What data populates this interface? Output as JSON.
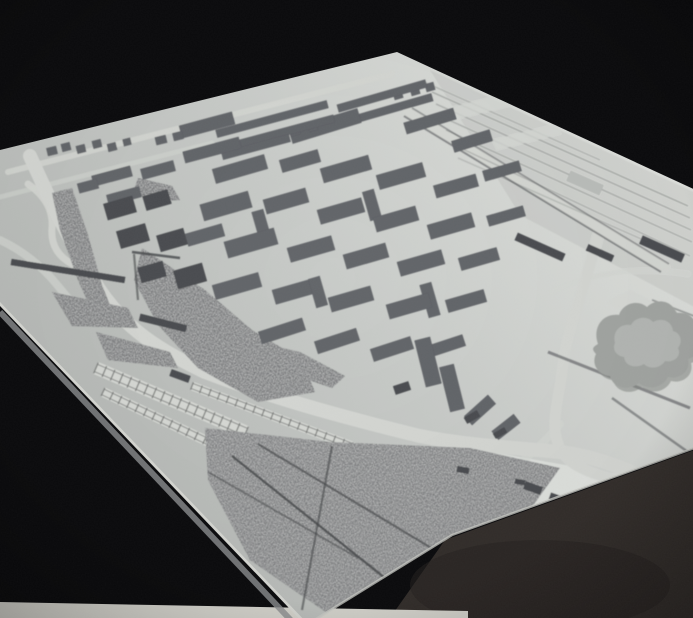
{
  "meta": {
    "subject": "architectural-scale-model-photo",
    "width": 693,
    "height": 618
  },
  "palette": {
    "background": "#0b0b0d",
    "base_hi": "#e4e6e2",
    "base_mid": "#c9ccc9",
    "base_lo": "#b4b7b4",
    "edge_band": "#d8d9d4",
    "edge_band_shadow": "#8e9092",
    "edge_highlight": "#c9cbc6",
    "bottom_strip": "#d5d4cd",
    "table": "#332e2b",
    "table_shadow": "#262220",
    "building_top": "#64666b",
    "building_side": "#37393d",
    "building_top_light": "#bcbfbc",
    "building_side_light": "#8f918f",
    "building_top_dark": "#4b4d51",
    "building_side_dark": "#2c2e32",
    "park": "#6e7072",
    "hill": "#747678",
    "road_light": "#d6d8d4",
    "ladder_band": "#d9dbd7",
    "ladder_rail": "#8e908e",
    "ladder_tie": "#7c7e7c",
    "rail": "#a8aba8",
    "dark": "#55575a",
    "crease": "#46484a",
    "blob_fill": "#a3a6a3",
    "blob_inner": "#b5b8b5",
    "blob_shadow": "#858885",
    "patch_light": "#d7d9d5"
  },
  "model_outline": [
    [
      0,
      150
    ],
    [
      397,
      52
    ],
    [
      700,
      192
    ],
    [
      700,
      446
    ],
    [
      452,
      535
    ],
    [
      308,
      624
    ],
    [
      0,
      302
    ]
  ],
  "bottom_strip": [
    [
      0,
      602
    ],
    [
      468,
      611
    ],
    [
      468,
      618
    ],
    [
      0,
      618
    ]
  ],
  "table_polygon": [
    [
      445,
      540
    ],
    [
      700,
      448
    ],
    [
      700,
      618
    ],
    [
      390,
      618
    ]
  ],
  "table_shadow_ellipse": {
    "cx": 540,
    "cy": 585,
    "rx": 130,
    "ry": 45,
    "opacity": 0.55
  },
  "edge_band": {
    "line": [
      0,
      298,
      310,
      622
    ],
    "shadow": [
      0,
      312,
      302,
      632
    ]
  },
  "edge_highlight_path": "M 700 446 L 452 535 L 308 624",
  "shading": {
    "bright_patch": [
      [
        468,
        448
      ],
      [
        640,
        478
      ],
      [
        610,
        540
      ],
      [
        500,
        548
      ]
    ],
    "tilt_shade": [
      [
        430,
        70
      ],
      [
        700,
        195
      ],
      [
        700,
        310
      ],
      [
        520,
        215
      ]
    ]
  },
  "roads": [
    {
      "d": "M 8 172 L 392 74",
      "w": 6,
      "o": 0.85
    },
    {
      "d": "M 0 197 L 212 143",
      "w": 5,
      "o": 0.55
    },
    {
      "d": "M 30 156 C 48 196 62 226 92 278 C 118 322 150 346 205 372 C 268 396 330 414 420 436 C 470 446 520 448 560 452 C 598 456 636 472 672 492",
      "w": 14,
      "o": 1
    },
    {
      "d": "M 28 184 Q 54 202 52 228 Q 50 252 72 264",
      "w": 7,
      "o": 0.9
    },
    {
      "d": "M 0 240 Q 34 256 58 286 Q 74 306 92 322",
      "w": 8,
      "o": 0.65
    },
    {
      "d": "M 598 236 C 584 290 566 330 562 372 C 558 404 548 428 562 452 C 574 472 612 478 648 490",
      "w": 11,
      "o": 1
    },
    {
      "d": "M 408 112 L 665 268",
      "w": 10,
      "o": 0.85
    },
    {
      "d": "M 552 292 Q 612 262 688 274",
      "w": 5,
      "o": 0.75
    },
    {
      "d": "M 560 424 C 536 452 516 468 486 486",
      "w": 8,
      "o": 0.65
    }
  ],
  "lines_under": [
    [
      432,
      92,
      688,
      206,
      1.5,
      "rail",
      0.9
    ],
    [
      436,
      104,
      690,
      218,
      1.5,
      "rail",
      0.85
    ],
    [
      440,
      116,
      691,
      230,
      1.5,
      "rail",
      0.8
    ],
    [
      446,
      130,
      692,
      242,
      1.5,
      "rail",
      0.8
    ],
    [
      452,
      144,
      690,
      256,
      1.5,
      "rail",
      0.7
    ],
    [
      424,
      82,
      600,
      160,
      1.5,
      "rail",
      0.7
    ],
    [
      458,
      158,
      648,
      242,
      1.5,
      "rail",
      0.6
    ],
    [
      404,
      116,
      661,
      272,
      2,
      "dark",
      0.6
    ],
    [
      412,
      108,
      669,
      264,
      1.8,
      "dark",
      0.5
    ],
    [
      548,
      352,
      690,
      408,
      3,
      "dark",
      0.6
    ],
    [
      612,
      398,
      688,
      452,
      2.5,
      "dark",
      0.55
    ],
    [
      652,
      300,
      694,
      316,
      2,
      "dark",
      0.45
    ],
    [
      172,
      292,
      310,
      384,
      2,
      "dark",
      0.45
    ]
  ],
  "lines_over": [
    [
      232,
      456,
      420,
      606,
      2.5,
      "crease",
      0.8
    ],
    [
      258,
      444,
      498,
      588,
      2.2,
      "crease",
      0.65
    ],
    [
      332,
      446,
      302,
      610,
      2.2,
      "crease",
      0.6
    ],
    [
      208,
      472,
      358,
      558,
      2,
      "crease",
      0.5
    ],
    [
      132,
      252,
      180,
      258,
      2.5,
      "crease",
      0.8
    ],
    [
      134,
      254,
      138,
      300,
      2.2,
      "crease",
      0.6
    ]
  ],
  "ladders": [
    [
      96,
      368,
      246,
      432,
      13
    ],
    [
      103,
      392,
      230,
      452,
      10
    ],
    [
      192,
      386,
      352,
      446,
      9
    ],
    [
      352,
      446,
      430,
      470,
      8
    ]
  ],
  "parks": [
    {
      "fill": "park",
      "points": [
        [
          52,
          193
        ],
        [
          72,
          188
        ],
        [
          88,
          235
        ],
        [
          102,
          285
        ],
        [
          112,
          310
        ],
        [
          95,
          318
        ],
        [
          78,
          280
        ],
        [
          60,
          230
        ]
      ]
    },
    {
      "fill": "park",
      "points": [
        [
          142,
          248
        ],
        [
          205,
          290
        ],
        [
          252,
          330
        ],
        [
          302,
          360
        ],
        [
          315,
          392
        ],
        [
          258,
          402
        ],
        [
          198,
          368
        ],
        [
          158,
          325
        ],
        [
          134,
          280
        ]
      ]
    },
    {
      "fill": "hill",
      "points": [
        [
          205,
          428
        ],
        [
          330,
          442
        ],
        [
          470,
          448
        ],
        [
          560,
          468
        ],
        [
          505,
          545
        ],
        [
          420,
          600
        ],
        [
          330,
          615
        ],
        [
          250,
          560
        ],
        [
          208,
          480
        ]
      ]
    },
    {
      "fill": "park",
      "points": [
        [
          212,
          332
        ],
        [
          300,
          352
        ],
        [
          345,
          376
        ],
        [
          332,
          388
        ],
        [
          250,
          360
        ],
        [
          208,
          348
        ]
      ]
    },
    {
      "fill": "park",
      "points": [
        [
          138,
          178
        ],
        [
          172,
          186
        ],
        [
          180,
          200
        ],
        [
          150,
          202
        ],
        [
          134,
          190
        ]
      ]
    },
    {
      "fill": "park",
      "points": [
        [
          52,
          292
        ],
        [
          128,
          308
        ],
        [
          138,
          328
        ],
        [
          72,
          326
        ]
      ]
    },
    {
      "fill": "park",
      "points": [
        [
          96,
          332
        ],
        [
          170,
          352
        ],
        [
          178,
          368
        ],
        [
          108,
          360
        ]
      ]
    }
  ],
  "patches": [
    [
      [
        607,
        302
      ],
      [
        630,
        290
      ],
      [
        655,
        303
      ],
      [
        631,
        316
      ]
    ],
    [
      [
        452,
        107
      ],
      [
        508,
        93
      ],
      [
        514,
        105
      ],
      [
        458,
        119
      ]
    ],
    [
      [
        492,
        140
      ],
      [
        556,
        124
      ],
      [
        561,
        134
      ],
      [
        497,
        150
      ]
    ]
  ],
  "blob": {
    "outer": "M 598 344 C 592 327 603 313 619 315 C 623 303 638 299 647 307 C 657 297 673 301 676 313 C 690 311 700 322 695 333 C 704 342 700 356 688 359 C 691 371 680 380 668 377 C 663 388 648 391 639 383 C 628 392 613 388 610 376 C 598 375 591 364 596 354 C 591 349 593 347 598 344 Z",
    "inner": "M 615 343 C 612 332 620 323 631 325 C 635 317 647 315 653 322 C 662 317 672 321 673 331 C 681 333 683 342 678 348 C 682 356 674 363 665 361 C 661 368 650 370 644 364 C 635 369 625 366 624 357 C 616 356 612 349 615 343 Z",
    "shadow_dx": 3,
    "shadow_dy": 4
  },
  "buildings": [
    [
      52,
      151,
      10,
      8,
      -14,
      4,
      0
    ],
    [
      66,
      147,
      9,
      8,
      -14,
      4,
      0
    ],
    [
      81,
      149,
      9,
      8,
      -14,
      4,
      0
    ],
    [
      97,
      144,
      9,
      8,
      -14,
      4,
      0
    ],
    [
      112,
      147,
      9,
      8,
      -14,
      4,
      0
    ],
    [
      127,
      142,
      8,
      7,
      -14,
      4,
      0
    ],
    [
      161,
      140,
      11,
      8,
      -14,
      4,
      0
    ],
    [
      178,
      136,
      10,
      8,
      -14,
      4,
      0
    ],
    [
      295,
      131,
      10,
      9,
      -16,
      4,
      0
    ],
    [
      313,
      127,
      9,
      8,
      -16,
      4,
      0
    ],
    [
      331,
      122,
      9,
      8,
      -16,
      4,
      0
    ],
    [
      350,
      117,
      9,
      8,
      -16,
      4,
      0
    ],
    [
      398,
      95,
      9,
      8,
      -16,
      4,
      0
    ],
    [
      415,
      91,
      9,
      8,
      -16,
      4,
      0
    ],
    [
      430,
      87,
      9,
      8,
      -16,
      4,
      0
    ],
    [
      272,
      119,
      115,
      8,
      -15,
      9,
      0
    ],
    [
      280,
      133,
      112,
      8,
      -15,
      9,
      0
    ],
    [
      256,
      147,
      70,
      8,
      -15,
      8,
      0
    ],
    [
      382,
      96,
      92,
      8,
      -16,
      9,
      0
    ],
    [
      391,
      109,
      86,
      8,
      -16,
      9,
      0
    ],
    [
      112,
      176,
      40,
      11,
      -15,
      8,
      0
    ],
    [
      158,
      170,
      34,
      11,
      -15,
      8,
      0
    ],
    [
      124,
      196,
      34,
      11,
      -15,
      8,
      0
    ],
    [
      88,
      186,
      20,
      10,
      -15,
      6,
      0
    ],
    [
      120,
      208,
      30,
      17,
      -16,
      14,
      2
    ],
    [
      157,
      200,
      26,
      15,
      -16,
      12,
      2
    ],
    [
      133,
      236,
      30,
      18,
      -16,
      18,
      2
    ],
    [
      172,
      240,
      28,
      17,
      -16,
      20,
      2
    ],
    [
      152,
      272,
      26,
      16,
      -16,
      22,
      2
    ],
    [
      190,
      276,
      30,
      19,
      -16,
      24,
      2
    ],
    [
      205,
      235,
      38,
      13,
      -16,
      8,
      0
    ],
    [
      207,
      125,
      55,
      13,
      -15,
      10,
      0
    ],
    [
      212,
      150,
      58,
      12,
      -15,
      10,
      0
    ],
    [
      325,
      126,
      72,
      15,
      -17,
      12,
      0
    ],
    [
      430,
      121,
      52,
      12,
      -17,
      10,
      0
    ],
    [
      472,
      141,
      40,
      12,
      -17,
      9,
      0
    ],
    [
      240,
      169,
      54,
      15,
      -16,
      11,
      0
    ],
    [
      300,
      161,
      40,
      13,
      -16,
      10,
      0
    ],
    [
      346,
      169,
      50,
      15,
      -16,
      12,
      0
    ],
    [
      401,
      176,
      48,
      15,
      -16,
      12,
      0
    ],
    [
      456,
      186,
      44,
      13,
      -16,
      10,
      0
    ],
    [
      502,
      171,
      38,
      11,
      -16,
      8,
      0
    ],
    [
      226,
      206,
      50,
      17,
      -16,
      12,
      0
    ],
    [
      286,
      201,
      44,
      15,
      -16,
      12,
      0
    ],
    [
      341,
      211,
      46,
      15,
      -16,
      12,
      0
    ],
    [
      396,
      219,
      44,
      15,
      -16,
      12,
      0
    ],
    [
      451,
      226,
      46,
      15,
      -16,
      11,
      0
    ],
    [
      506,
      216,
      38,
      11,
      -16,
      8,
      0
    ],
    [
      251,
      243,
      52,
      17,
      -16,
      12,
      0
    ],
    [
      311,
      249,
      46,
      15,
      -16,
      12,
      0
    ],
    [
      366,
      256,
      44,
      15,
      -16,
      12,
      0
    ],
    [
      421,
      263,
      46,
      15,
      -16,
      12,
      0
    ],
    [
      479,
      259,
      40,
      13,
      -16,
      10,
      0
    ],
    [
      237,
      286,
      48,
      15,
      -16,
      12,
      0
    ],
    [
      296,
      291,
      46,
      15,
      -16,
      12,
      0
    ],
    [
      351,
      299,
      44,
      15,
      -16,
      12,
      0
    ],
    [
      409,
      306,
      44,
      15,
      -16,
      12,
      0
    ],
    [
      466,
      301,
      40,
      13,
      -16,
      10,
      0
    ],
    [
      282,
      331,
      46,
      13,
      -18,
      11,
      0
    ],
    [
      337,
      341,
      44,
      13,
      -18,
      11,
      0
    ],
    [
      392,
      349,
      42,
      13,
      -18,
      11,
      0
    ],
    [
      446,
      346,
      38,
      12,
      -18,
      10,
      0
    ],
    [
      262,
      227,
      12,
      34,
      -16,
      12,
      0
    ],
    [
      318,
      292,
      12,
      30,
      -16,
      12,
      0
    ],
    [
      430,
      300,
      12,
      34,
      -16,
      12,
      0
    ],
    [
      372,
      205,
      12,
      30,
      -16,
      12,
      0
    ],
    [
      428,
      362,
      16,
      48,
      -14,
      14,
      0
    ],
    [
      452,
      388,
      15,
      46,
      -14,
      14,
      0
    ],
    [
      480,
      410,
      32,
      12,
      -42,
      10,
      0
    ],
    [
      506,
      427,
      28,
      11,
      -38,
      9,
      0
    ],
    [
      402,
      388,
      16,
      9,
      -18,
      6,
      2
    ],
    [
      540,
      247,
      52,
      8,
      24,
      5,
      2
    ],
    [
      600,
      253,
      28,
      7,
      24,
      4,
      2
    ],
    [
      662,
      249,
      46,
      9,
      24,
      6,
      2
    ],
    [
      585,
      183,
      36,
      11,
      24,
      8,
      1
    ],
    [
      68,
      271,
      115,
      6,
      9,
      4,
      2
    ],
    [
      163,
      323,
      48,
      7,
      14,
      4,
      2
    ],
    [
      180,
      376,
      20,
      7,
      20,
      4,
      2
    ],
    [
      533,
      488,
      18,
      8,
      20,
      4,
      2
    ],
    [
      556,
      498,
      13,
      7,
      20,
      4,
      2
    ],
    [
      472,
      417,
      15,
      7,
      -30,
      4,
      2
    ],
    [
      500,
      433,
      13,
      6,
      -30,
      4,
      2
    ],
    [
      463,
      470,
      12,
      6,
      10,
      3,
      2
    ],
    [
      520,
      482,
      10,
      5,
      10,
      3,
      2
    ]
  ]
}
